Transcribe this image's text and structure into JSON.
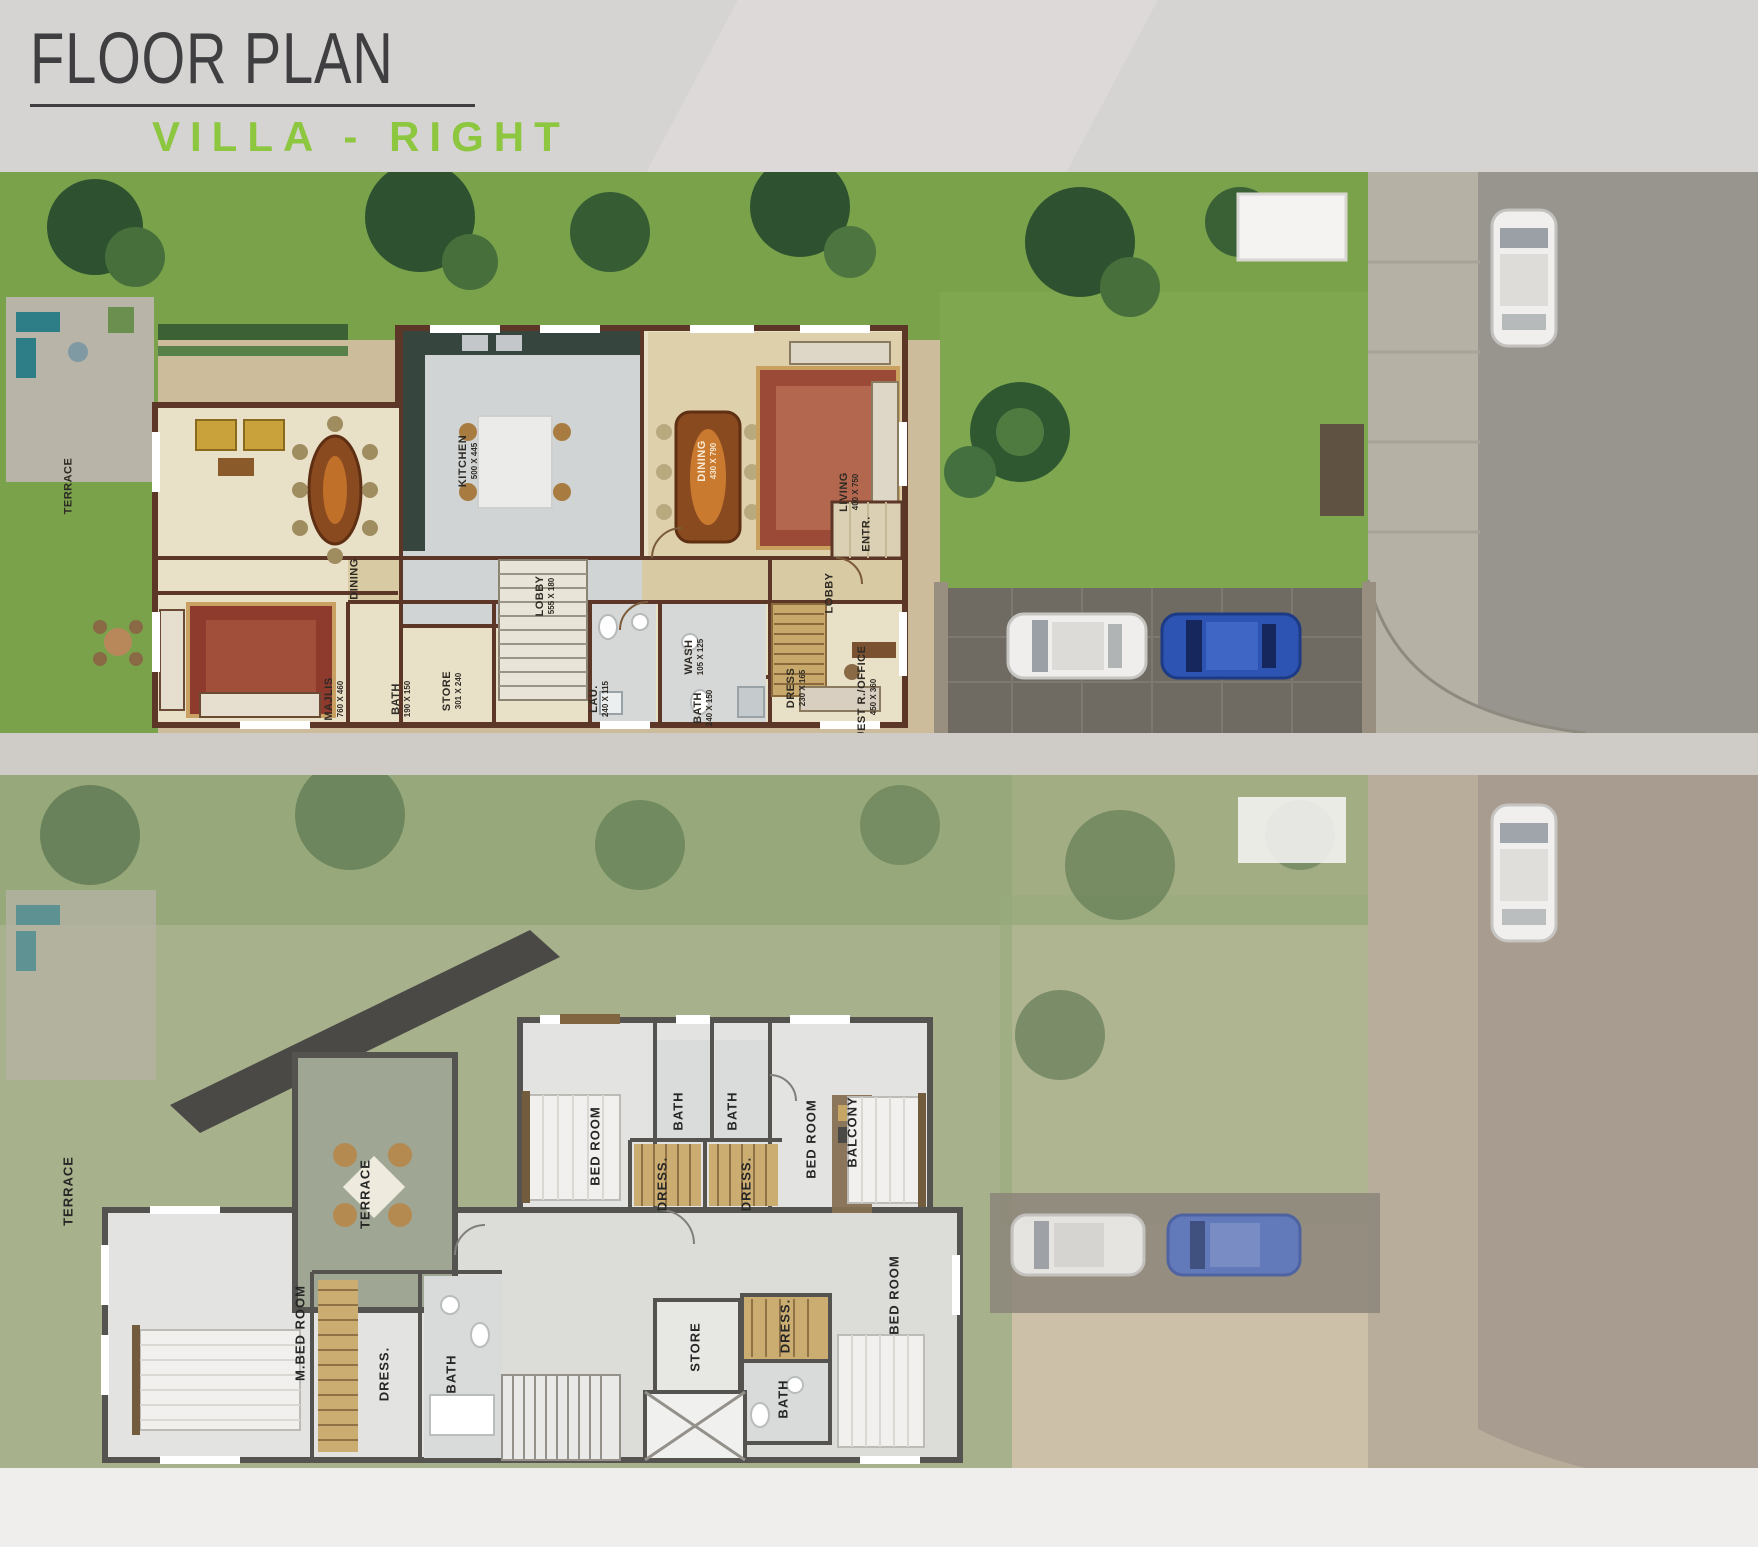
{
  "header": {
    "title": "FLOOR PLAN",
    "subtitle": "VILLA  -  RIGHT"
  },
  "colors": {
    "accent_green": "#8dc63f",
    "title_gray": "#3f3e40",
    "lawn_green": "#79a24b",
    "ground_wall_brown": "#5c3626",
    "first_wall_gray": "#4a4945",
    "blue_car": "#2d54b2",
    "terrace_gray_green": "#9aa28e"
  },
  "plans": [
    {
      "labels": [
        {
          "t": "TERRACE",
          "x": 3.9,
          "y": 56.0
        },
        {
          "t": "DINING",
          "x": 20.2,
          "y": 72.5
        },
        {
          "t": "KITCHEN",
          "d": "500 X 445",
          "x": 26.6,
          "y": 51.5
        },
        {
          "t": "DINING",
          "d": "430 X 790",
          "x": 40.2,
          "y": 51.5,
          "light": true
        },
        {
          "t": "LIVING",
          "d": "400 X 750",
          "x": 48.3,
          "y": 57.0
        },
        {
          "t": "LOBBY",
          "d": "555 X 180",
          "x": 31.0,
          "y": 75.5
        },
        {
          "t": "LOBBY",
          "x": 47.2,
          "y": 75.0
        },
        {
          "t": "ENTR.",
          "x": 49.3,
          "y": 64.5
        },
        {
          "t": "MAJLIS",
          "d": "760 X 460",
          "x": 19.0,
          "y": 94.0
        },
        {
          "t": "BATH",
          "d": "190 X 150",
          "x": 22.8,
          "y": 94.0
        },
        {
          "t": "STORE",
          "d": "301 X 240",
          "x": 25.7,
          "y": 92.5
        },
        {
          "t": "LAU.",
          "d": "240 X 115",
          "x": 34.1,
          "y": 94.0
        },
        {
          "t": "WASH",
          "d": "105 X 125",
          "x": 39.5,
          "y": 86.5
        },
        {
          "t": "BATH",
          "d": "240 X 150",
          "x": 40.0,
          "y": 95.5
        },
        {
          "t": "DRESS",
          "d": "230 X 165",
          "x": 45.3,
          "y": 92.0
        },
        {
          "t": "GUEST R./OFFICE",
          "d": "450 X 360",
          "x": 49.3,
          "y": 93.5
        }
      ]
    },
    {
      "labels": [
        {
          "t": "TERRACE",
          "x": 3.9,
          "y": 60.0
        },
        {
          "t": "TERRACE",
          "x": 20.8,
          "y": 60.5
        },
        {
          "t": "BED ROOM",
          "x": 33.9,
          "y": 53.5
        },
        {
          "t": "BATH",
          "x": 38.6,
          "y": 48.5
        },
        {
          "t": "BATH",
          "x": 41.7,
          "y": 48.5
        },
        {
          "t": "DRESS.",
          "x": 37.7,
          "y": 59.0
        },
        {
          "t": "DRESS.",
          "x": 42.5,
          "y": 59.0
        },
        {
          "t": "BED ROOM",
          "x": 46.2,
          "y": 52.5
        },
        {
          "t": "BALCONY",
          "x": 48.5,
          "y": 51.5
        },
        {
          "t": "M.BED ROOM",
          "x": 17.1,
          "y": 80.5
        },
        {
          "t": "DRESS.",
          "x": 21.9,
          "y": 86.5
        },
        {
          "t": "BATH",
          "x": 25.7,
          "y": 86.5
        },
        {
          "t": "STORE",
          "x": 39.6,
          "y": 82.5
        },
        {
          "t": "DRESS.",
          "x": 44.7,
          "y": 79.5
        },
        {
          "t": "BATH",
          "x": 44.6,
          "y": 90.0
        },
        {
          "t": "BED ROOM",
          "x": 50.9,
          "y": 75.0
        }
      ]
    }
  ]
}
